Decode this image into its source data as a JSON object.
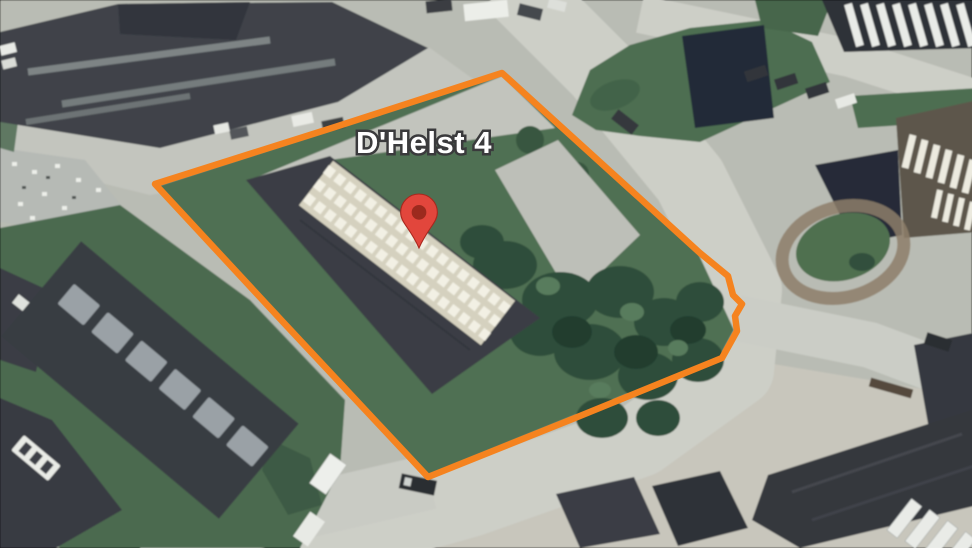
{
  "map": {
    "imagery": "satellite-aerial-photo",
    "address_label": "D'Helst 4",
    "marker_icon": "red-map-pin",
    "boundary": "orange-property-outline"
  },
  "colors": {
    "boundary-orange": "#F5831F",
    "pin-red": "#E2463C",
    "pin-inner-red": "#9C2A1E",
    "label-text": "#FFFFFF",
    "label-outline": "#3A3A3C"
  }
}
